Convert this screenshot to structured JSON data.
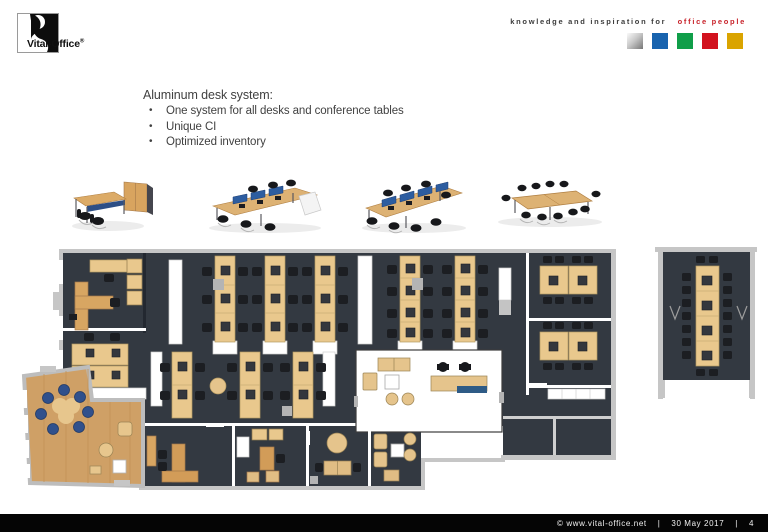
{
  "logo": {
    "brand": "Vital-Office",
    "registered": "®"
  },
  "header": {
    "tagline_black": "knowledge and inspiration for",
    "tagline_red": "office people",
    "squares": [
      {
        "name": "silver-square",
        "color": "linear-gradient(135deg,#fafafa 0%,#c9c9c9 45%,#767676 100%)"
      },
      {
        "name": "blue-square",
        "color": "#1863ae"
      },
      {
        "name": "green-square",
        "color": "#109e49"
      },
      {
        "name": "red-square",
        "color": "#d2121e"
      },
      {
        "name": "yellow-square",
        "color": "#daa400"
      }
    ]
  },
  "content": {
    "heading": "Aluminum desk system:",
    "bullets": [
      "One system for all desks and conference tables",
      "Unique CI",
      "Optimized inventory"
    ]
  },
  "products": {
    "icons": [
      "executive-desk-icon",
      "bench-desk-4-icon",
      "bench-desk-8-icon",
      "conference-table-icon"
    ]
  },
  "palette": {
    "slide_bg": "#ffffff",
    "text_color": "#414141",
    "tagline_red": "#c8232b",
    "footer_bg": "#050505",
    "footer_text": "#f2f2f2",
    "plan_room_dark": "#333941",
    "plan_desk_tan": "#e9c88d",
    "plan_wood_floor": "#cfa066",
    "plan_wall_gray": "#c6c6c6",
    "reception_counter_blue": "#2e5b86",
    "lounge_chair_blue": "#30508c",
    "screen_blue": "#2d5da0"
  },
  "footer": {
    "copyright": "©  www.vital-office.net",
    "separator": "|",
    "date": "30 May 2017",
    "page": "4"
  }
}
